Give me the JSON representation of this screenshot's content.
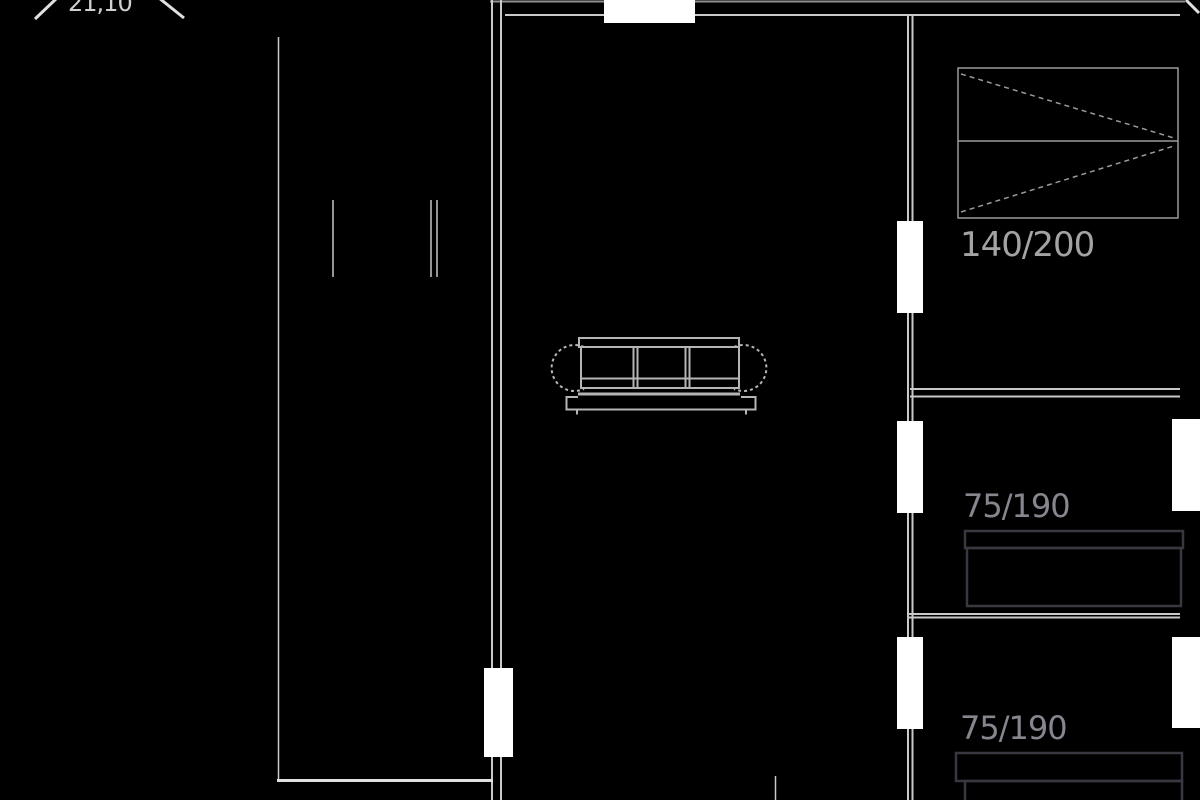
{
  "title": "Apartment floor plan drawing",
  "colors": {
    "background": "#000000",
    "wall": "#c9c9c9",
    "wall_dim": "#8f8f8f",
    "wall_bright": "#e0e0e0",
    "opening": "#ffffff",
    "furniture": "#b5b5b5",
    "bed": "#383840",
    "label": "#86868e",
    "label_bright": "#a3a3a3"
  },
  "labels": {
    "wardrobe_size": "140/200",
    "bed_middle_size": "75/190",
    "bed_bottom_size": "75/190",
    "clipped_dimension": "21,10"
  },
  "furniture": {
    "sofa": "3-seat sofa, top view, living room center",
    "wardrobe": "sliding wardrobe with dashed door diagonals, top right room",
    "bed_middle": "single bed with pillow, middle right room",
    "bed_bottom": "single bed with pillow, bottom right room (clipped by image edge)"
  }
}
